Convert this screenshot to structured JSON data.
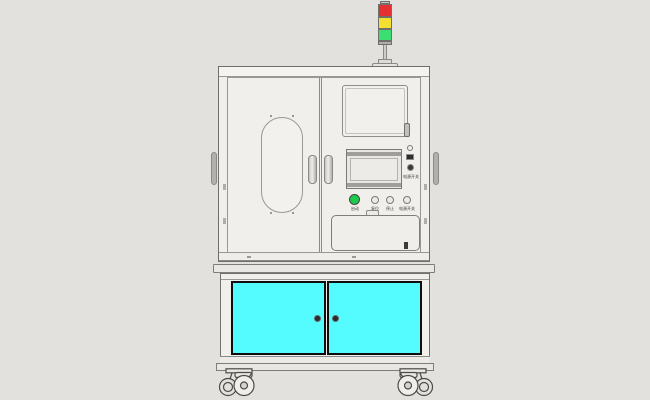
{
  "scene": {
    "background_color": "#e3e1de",
    "subject": "cad-render-industrial-test-machine-cabinet"
  },
  "signal_tower": {
    "segments": [
      {
        "name": "red-light",
        "color": "#e43030"
      },
      {
        "name": "yellow-light",
        "color": "#f2e030"
      },
      {
        "name": "green-light",
        "color": "#3bdf70"
      }
    ]
  },
  "control_panel": {
    "buttons": [
      {
        "label": "启动",
        "color": "#1fc94e"
      },
      {
        "label": "复位",
        "color": "#eceae7"
      },
      {
        "label": "停止",
        "color": "#eceae7"
      },
      {
        "label": "电源开关",
        "color": "#eceae7"
      }
    ],
    "io_label": "电源开关"
  },
  "lower_cabinet": {
    "door_color": "#55fcff",
    "door_count": "2"
  }
}
